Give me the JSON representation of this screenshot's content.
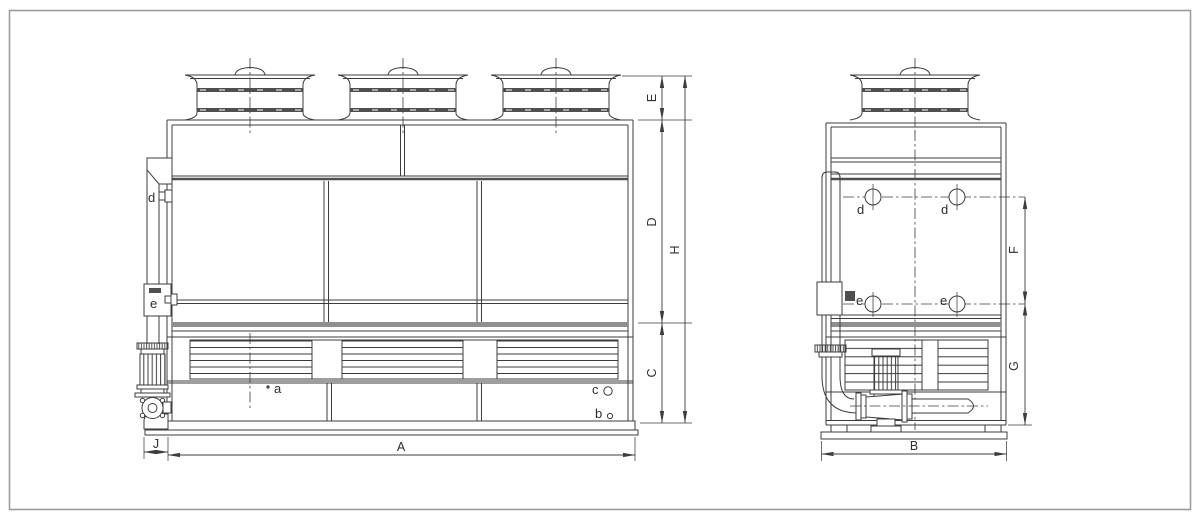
{
  "colors": {
    "background": "#ffffff",
    "frame": "#9c9c9c",
    "line": "#3c3c3c",
    "line-heavy": "#4f4f4f",
    "band": "#8f8f8f",
    "text": "#2f2f2f"
  },
  "front_view": {
    "dimension_labels": {
      "E": "E",
      "D": "D",
      "C": "C",
      "H": "H",
      "J": "J",
      "A": "A"
    },
    "part_labels": {
      "a": "a",
      "b": "b",
      "c": "c",
      "d": "d",
      "e": "e"
    }
  },
  "side_view": {
    "dimension_labels": {
      "F": "F",
      "G": "G",
      "B": "B"
    },
    "part_labels": {
      "d_left": "d",
      "d_right": "d",
      "e_left": "e",
      "e_right": "e"
    }
  }
}
